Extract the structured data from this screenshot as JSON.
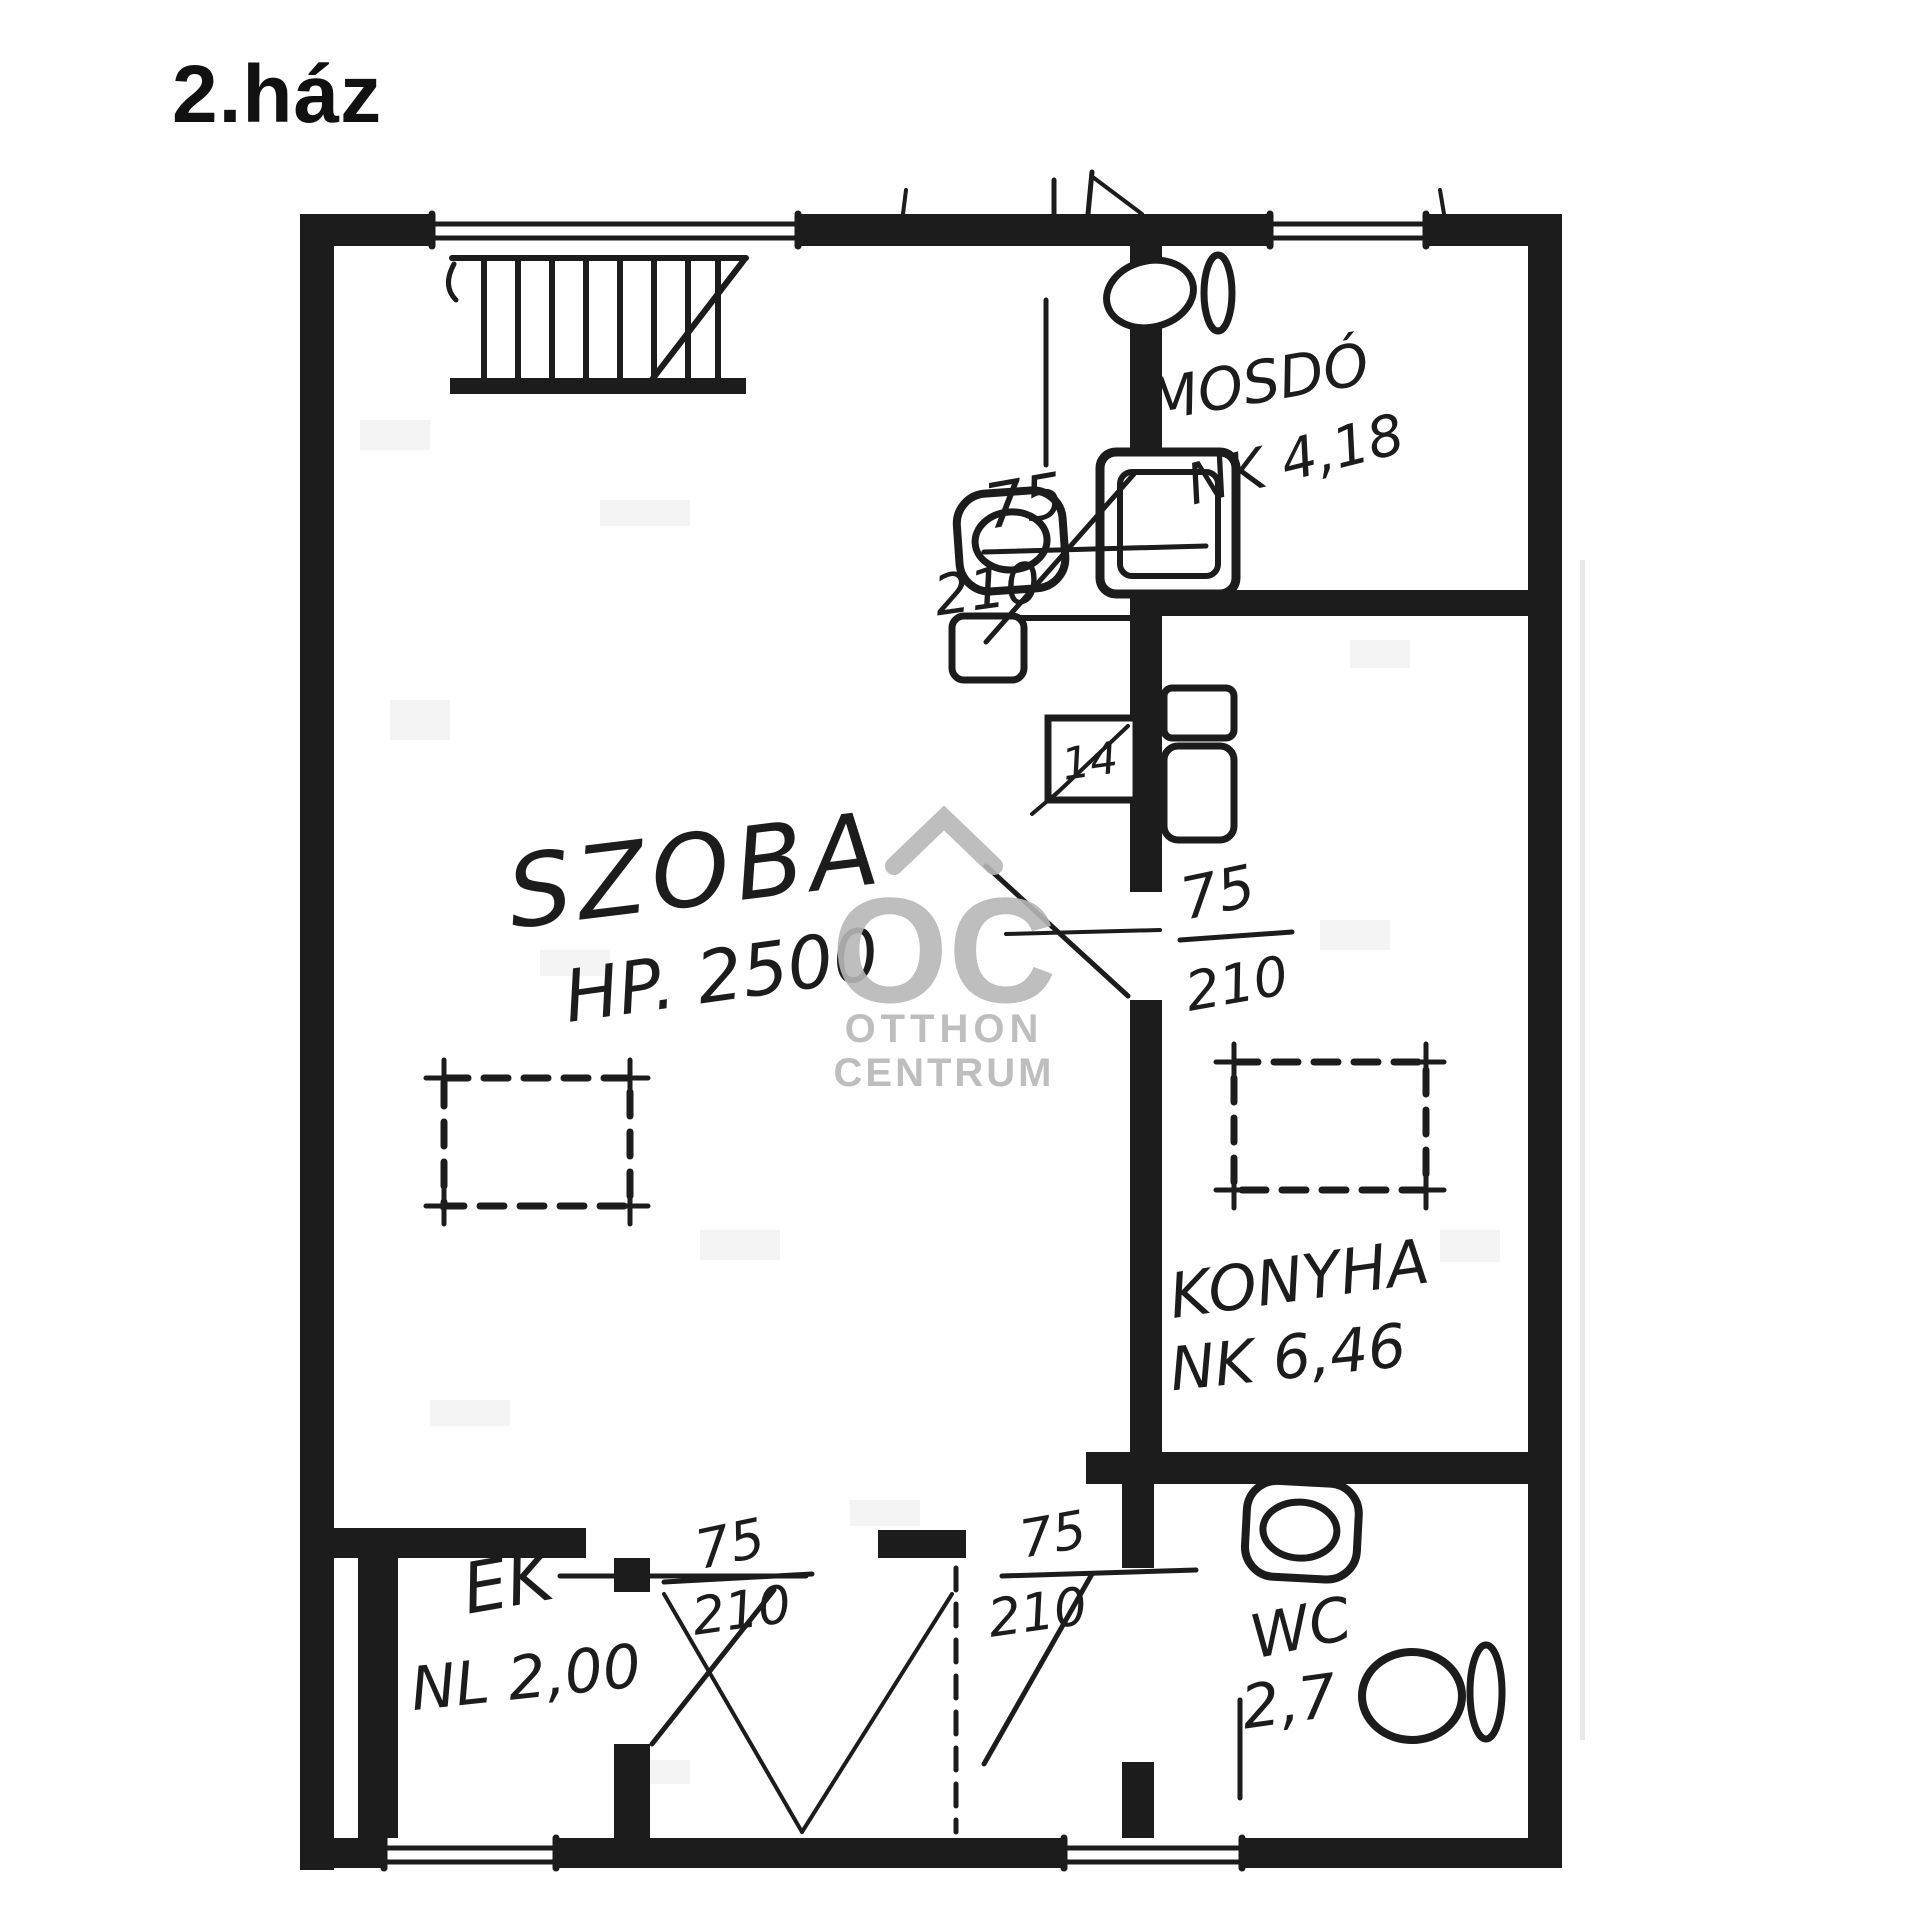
{
  "title": "2.ház",
  "colors": {
    "ink": "#1c1c1c",
    "watermark": "#b7b7b7",
    "paper": "#ffffff"
  },
  "rooms": {
    "szoba": {
      "name": "SZOBA",
      "dim": "HP. 2500"
    },
    "mosdo": {
      "name": "MOSDÓ",
      "dim": "NK 4,18"
    },
    "konyha": {
      "name": "KONYHA",
      "dim": "NK 6,46"
    },
    "ek": {
      "name": "ÉK",
      "dim": "NL 2,00"
    },
    "wc": {
      "name": "WC",
      "dim": "2,7"
    }
  },
  "door_annotations": [
    {
      "id": "mosdo-door",
      "width": "75",
      "height": "210"
    },
    {
      "id": "konyha-door",
      "width": "75",
      "height": "210"
    },
    {
      "id": "ek-door",
      "width": "75",
      "height": "210"
    },
    {
      "id": "wc-door",
      "width": "75",
      "height": "210"
    }
  ],
  "flue_label": "14",
  "watermark": {
    "logo": "OC",
    "line1": "OTTHON",
    "line2": "CENTRUM"
  }
}
